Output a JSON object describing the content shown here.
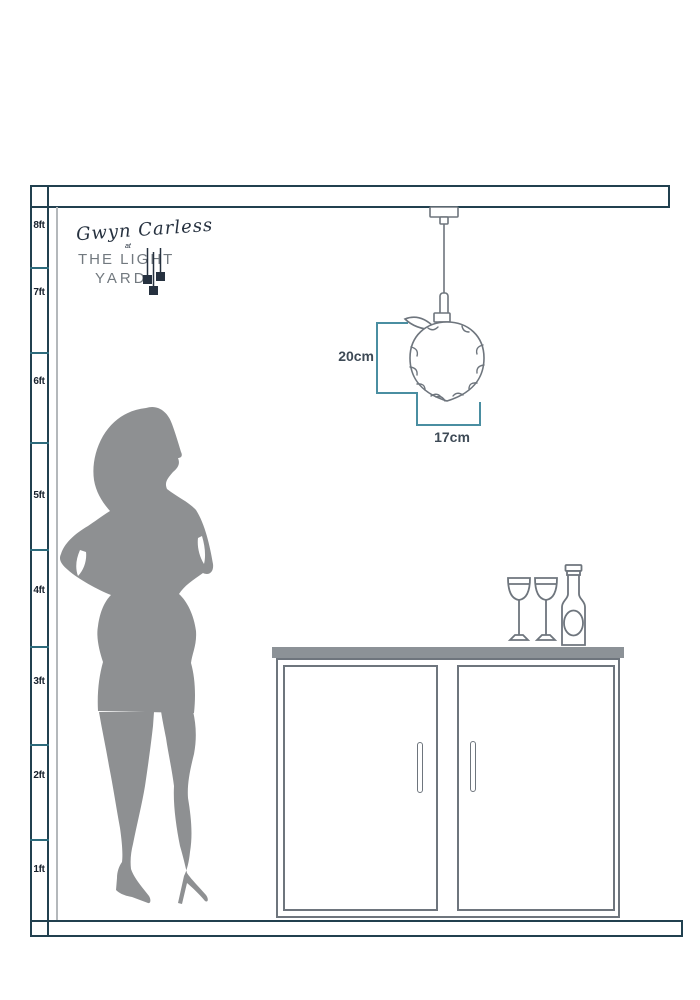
{
  "scene": {
    "description": "Pendant light size guide diagram with height ruler, person silhouette and sideboard"
  },
  "ruler": {
    "labels": [
      "8ft",
      "7ft",
      "6ft",
      "5ft",
      "4ft",
      "3ft",
      "2ft",
      "1ft"
    ]
  },
  "logo": {
    "signature": "Gwyn Carless",
    "connector": "at",
    "brand_line1": "THE LIGHT",
    "brand_line2": "YARD"
  },
  "pendant": {
    "height_label": "20cm",
    "width_label": "17cm"
  },
  "icons": [
    "pendant-light-icon",
    "woman-silhouette-icon",
    "cabinet-icon",
    "wine-glass-icon",
    "wine-bottle-icon",
    "logo-pendant-squares-icon"
  ],
  "colors": {
    "structure_navy": "#21404f",
    "tick_teal": "#2d6b7c",
    "dimension_teal": "#4a8ea1",
    "dimension_text": "#3e4a56",
    "outline_gray": "#6e757d",
    "silhouette_gray": "#8e9092",
    "counter_gray": "#8c9297",
    "wall_gray": "#b4b8bb",
    "logo_navy": "#26313f",
    "logo_gray": "#72797f"
  }
}
